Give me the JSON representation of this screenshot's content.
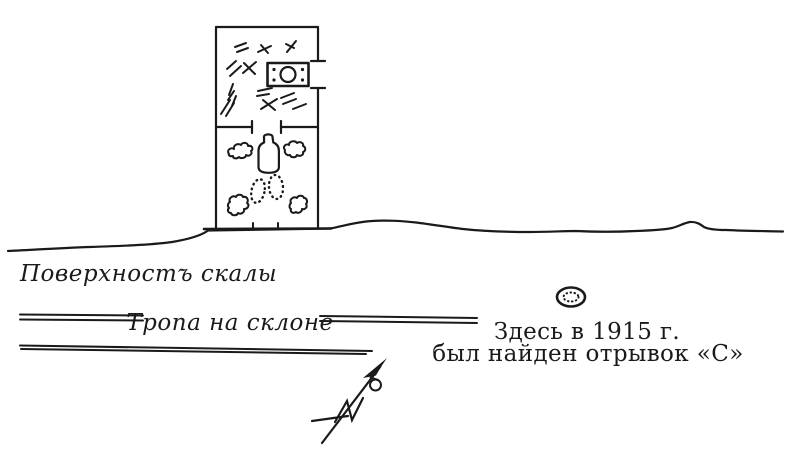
{
  "figure": {
    "colors": {
      "ink": "#1a1a1a",
      "paper": "#ffffff"
    },
    "labels": {
      "rock_surface": "Поверхностъ скалы",
      "slope_path": "Тропа на склоне",
      "find_note_line1": "Здесь в 1915 г.",
      "find_note_line2": "был найден отрывок «С»"
    },
    "icons": {
      "chamber_plan": "chamber-plan-icon",
      "stone_chest": "stone-chest-icon",
      "vessel": "vessel-icon",
      "footprints": "footprint-marks-icon",
      "stones": "stone-blob-icon",
      "debris": "debris-marks-icon",
      "find_spot": "find-spot-oval-icon",
      "north_arrow": "north-arrow-icon"
    }
  }
}
